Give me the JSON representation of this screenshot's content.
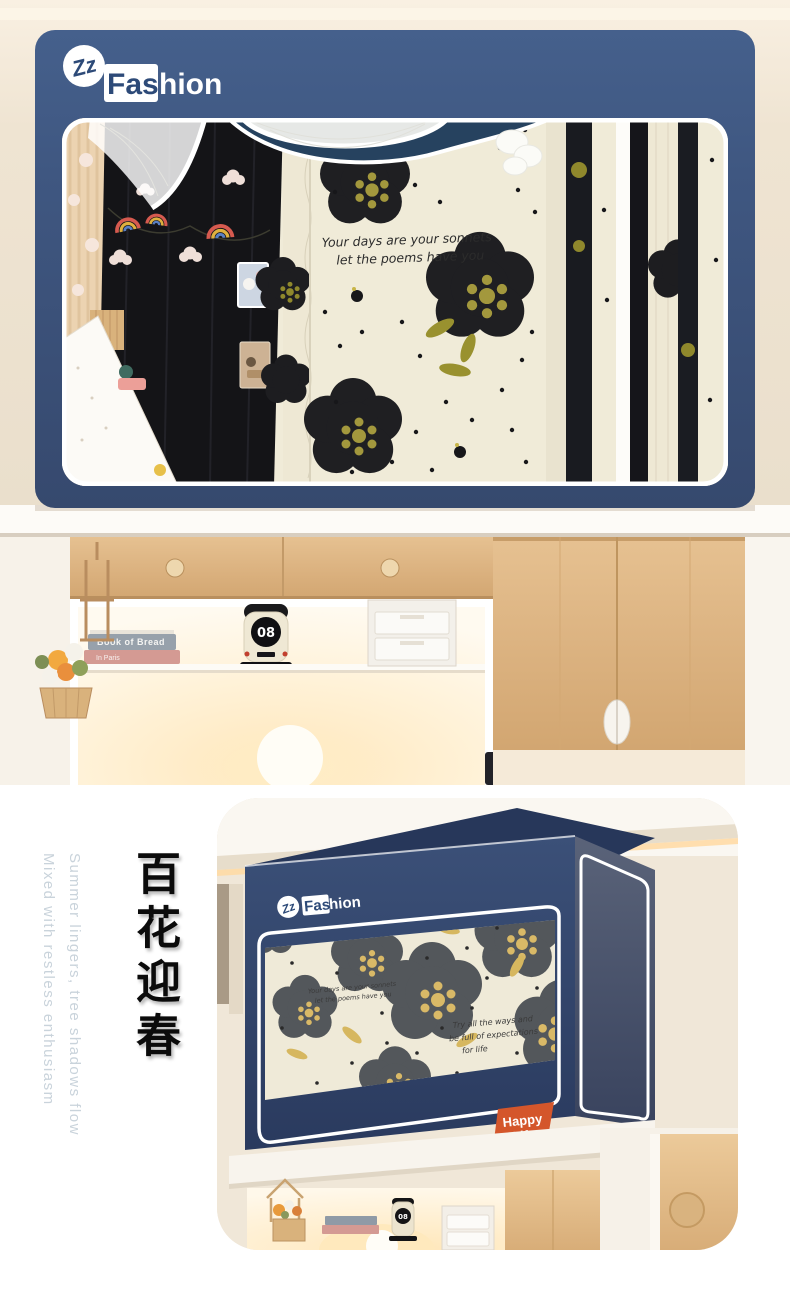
{
  "brand": {
    "zz": "Zz",
    "fas": "Fas",
    "hion": "hion",
    "name": "Fashion"
  },
  "hero": {
    "quote_line1": "Your days are your sonnets",
    "quote_line2": "let the poems have you"
  },
  "desk": {
    "book_top": "Book of Bread",
    "book_bottom": "In Paris",
    "clock": "08"
  },
  "promo": {
    "headline_zh": "百花迎春",
    "tagline_line1": "Summer lingers, tree shadows flow",
    "tagline_line2": "Mixed with restless enthusiasm"
  },
  "card": {
    "quote1_line1": "Your days are your sonnets",
    "quote1_line2": "let the poems have you",
    "quote2_line1": "Try all the ways and",
    "quote2_line2": "be full of expectations",
    "quote2_line3": "for life",
    "badge_line1": "Happy",
    "badge_line2": "Life",
    "clock": "08"
  },
  "colors": {
    "navy": "#3f5781",
    "navy_dark": "#2c3c60",
    "cream": "#f0ebd8",
    "flower_black": "#1f1f22",
    "flower_gray": "#53575b",
    "stamen_olive": "#a3983d",
    "stamen_tan": "#d9b967",
    "badge_orange": "#d4562b",
    "wood": "#dfb988",
    "tagline": "#c9d3db"
  }
}
